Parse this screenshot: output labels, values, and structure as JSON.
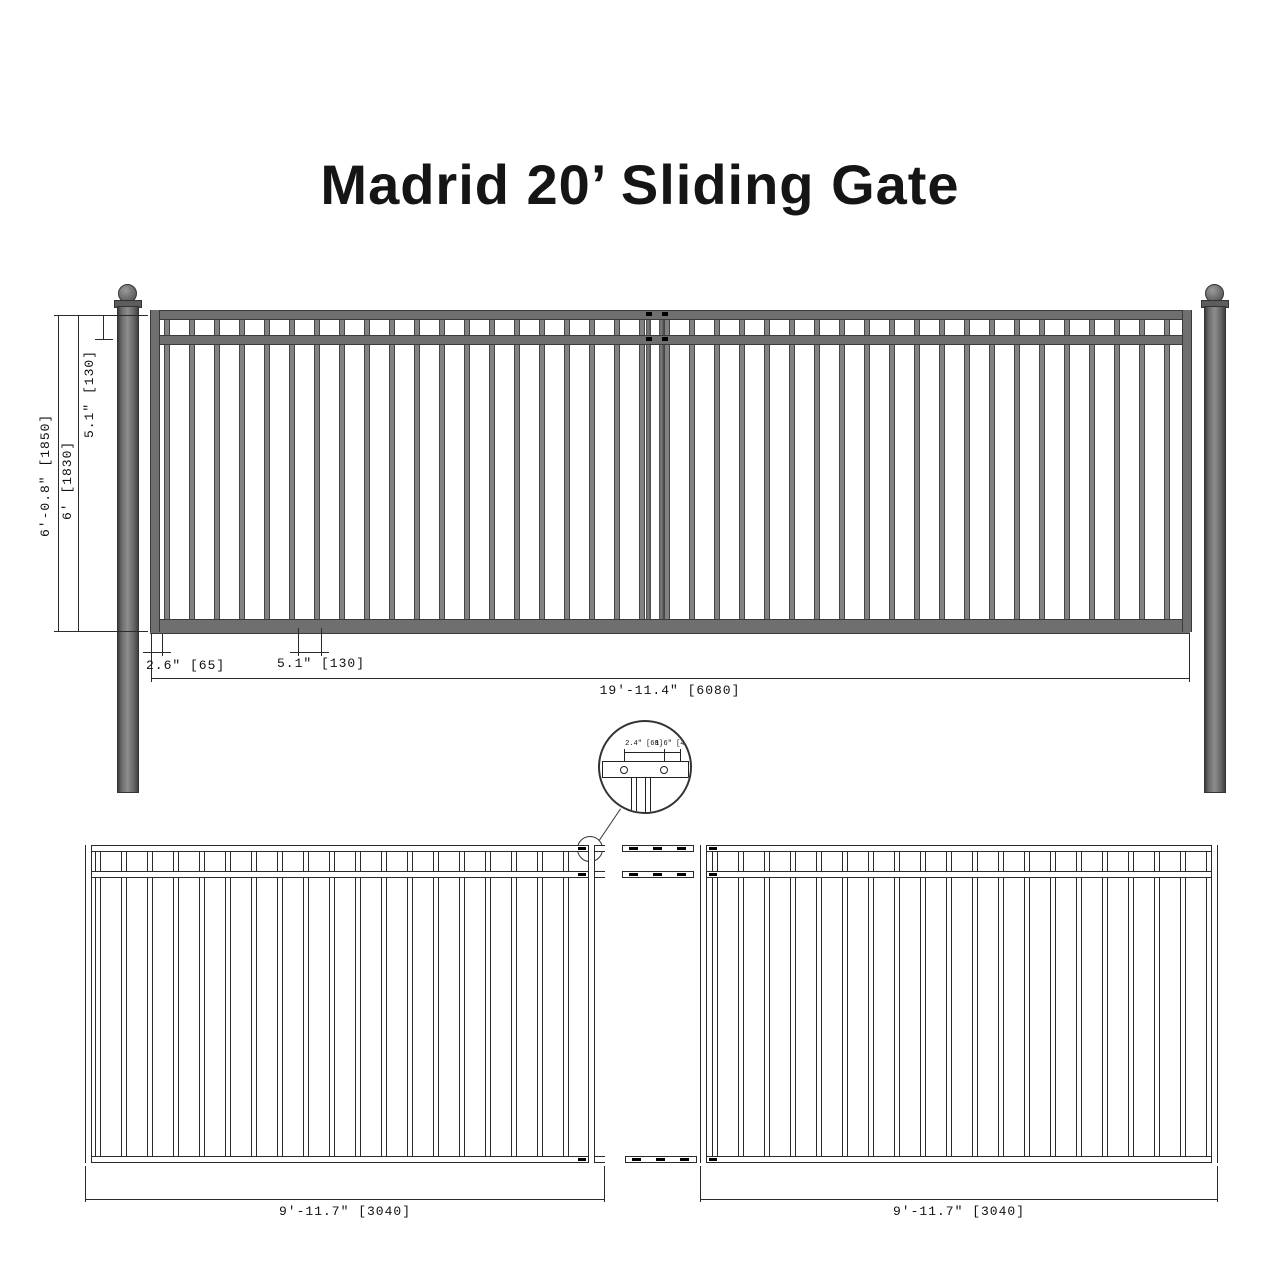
{
  "title": "Madrid 20’ Sliding Gate",
  "elevation_view": {
    "overall_height_label": "6'-0.8\" [1850]",
    "gate_height_label": "6' [1830]",
    "top_rail_spacing_label": "5.1\" [130]",
    "picket_edge_offset_label": "2.6\" [65]",
    "picket_spacing_label": "5.1\" [130]",
    "overall_width_label": "19'-11.4\" [6080]"
  },
  "detail_view": {
    "hole_spacing_label": "2.4\" [60]",
    "hole_edge_offset_label": "1.6\" [40]"
  },
  "plan_view": {
    "left_panel_width_label": "9'-11.7\" [3040]",
    "right_panel_width_label": "9'-11.7\" [3040]"
  },
  "colors": {
    "steel_fill": "#6f6f6f",
    "steel_dark": "#3a3a3a",
    "line": "#2a2a2a",
    "background": "#ffffff"
  }
}
